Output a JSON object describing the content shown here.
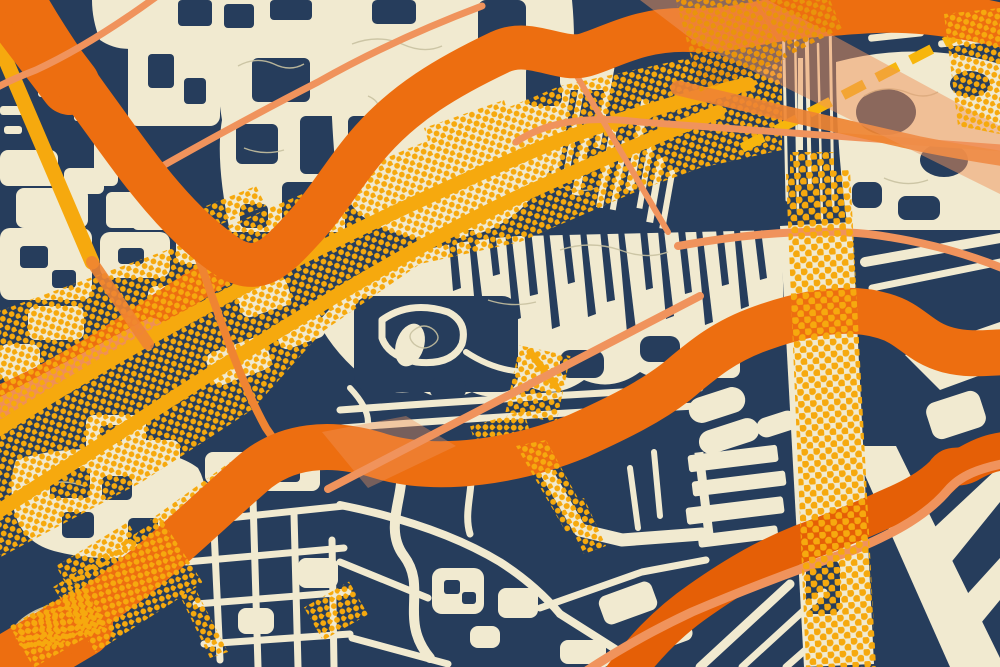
{
  "window": {
    "type": "map-art-poster",
    "description": "Stylized pop-art street map: navy water/background, cream city blocks with olive contour lines, orange highway ribbons, salmon secondary roads, yellow roads, a dashed yellow railway line, and yellow halftone-dot highway corridors (one long diagonal corridor and one vertical corridor)."
  },
  "canvas": {
    "width": 1000,
    "height": 667
  },
  "palette": {
    "navy": "#263D5C",
    "cream": "#F1EAD0",
    "olive": "#C8C1A0",
    "orange": "#ED6E10",
    "orange_deep": "#E55F06",
    "orange_mid": "#EF8432",
    "salmon": "#F0935C",
    "yellow": "#F6A90E",
    "yellow_deep": "#E9940B",
    "yellow_bright": "#F7B60D"
  },
  "layers": [
    {
      "name": "base-water",
      "desc": "navy background"
    },
    {
      "name": "city-blocks",
      "desc": "cream building blobs, street grids, streak textures, contour squiggles, stadium oval, track ring, pier, angular wedges"
    },
    {
      "name": "road-branch-left",
      "desc": "orange/salmon branch descending to left edge"
    },
    {
      "name": "halftone-corridor",
      "desc": "diagonal yellow halftone dot corridor from lower-left to upper-right"
    },
    {
      "name": "yellow-roads",
      "desc": "two solid yellow roads in the corridor, left yellow stripe, dashed yellow railway line top-right"
    },
    {
      "name": "thin-roads-under",
      "desc": "thin salmon/orange connector roads beneath highways"
    },
    {
      "name": "highway-connector",
      "desc": "medium orange connector to right edge"
    },
    {
      "name": "orange-highways",
      "desc": "three thick orange highway ribbons"
    },
    {
      "name": "thin-roads-over",
      "desc": "thin salmon roads crossing over highways, translucent swaths"
    },
    {
      "name": "halftone-accents",
      "desc": "halftone patches over ribbons, piers, stadium, top-right corner"
    },
    {
      "name": "halftone-vertical-road",
      "desc": "vertical yellow halftone corridor on the right"
    }
  ]
}
